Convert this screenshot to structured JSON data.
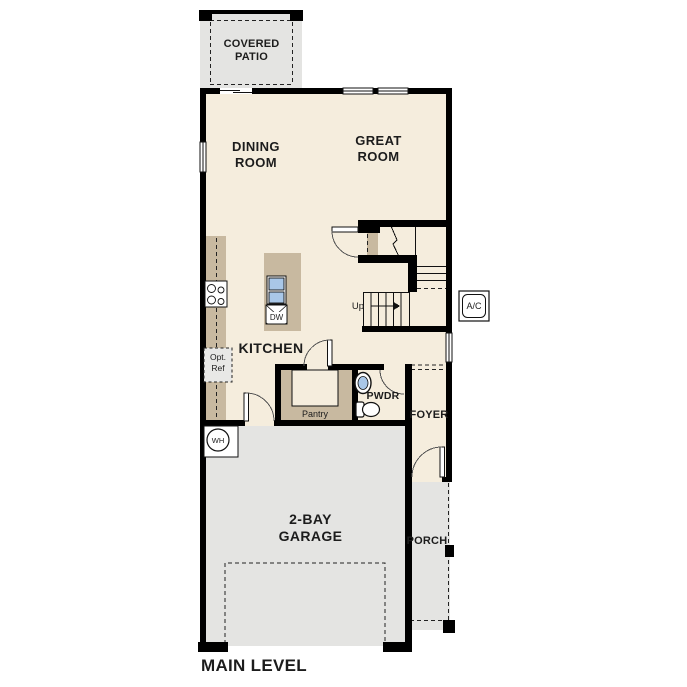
{
  "plan_title": "MAIN LEVEL",
  "colors": {
    "floor_cream": "#f5eddd",
    "hardscape_gray": "#e4e4e2",
    "cabinet_tan": "#c8b9a0",
    "wall_black": "#000000",
    "fixture_blue": "#a9c7e8",
    "background": "#ffffff"
  },
  "rooms": {
    "covered_patio": {
      "label": "COVERED\nPATIO"
    },
    "dining_room": {
      "label": "DINING\nROOM"
    },
    "great_room": {
      "label": "GREAT\nROOM"
    },
    "kitchen": {
      "label": "KITCHEN"
    },
    "pantry": {
      "label": "Pantry"
    },
    "powder_room": {
      "label": "PWDR"
    },
    "foyer": {
      "label": "FOYER"
    },
    "porch": {
      "label": "PORCH"
    },
    "garage": {
      "label": "2-BAY\nGARAGE"
    }
  },
  "fixtures": {
    "optional_refrigerator": {
      "label": "Opt.\nRef"
    },
    "dishwasher": {
      "label": "DW"
    },
    "water_heater": {
      "label": "WH"
    },
    "air_conditioner": {
      "label": "A/C"
    },
    "stairs_direction": {
      "label": "Up"
    }
  }
}
